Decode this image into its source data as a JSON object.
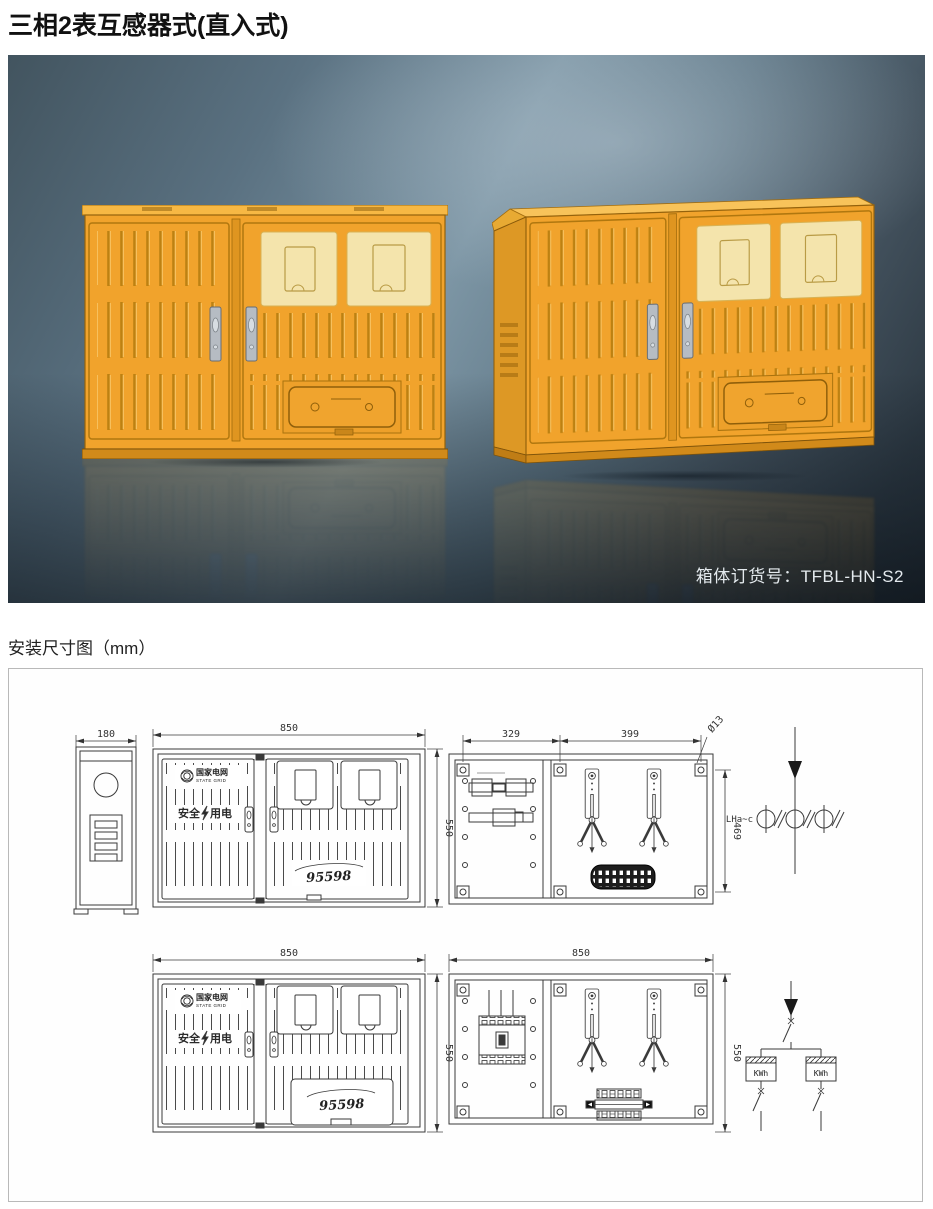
{
  "page": {
    "title": "三相2表互感器式(直入式)",
    "drawings_title": "安装尺寸图（mm）"
  },
  "photo": {
    "order_label": "箱体订货号：TFBL-HN-S2"
  },
  "branding": {
    "grid_cn": "国家电网",
    "grid_en": "STATE GRID",
    "safety_left": "安全",
    "safety_right": "用电",
    "hotline": "95598"
  },
  "dims": {
    "depth": "180",
    "width": "850",
    "height": "550",
    "mount_w1": "329",
    "mount_w2": "399",
    "mount_h": "469",
    "hole": "Ø13"
  },
  "schematics": {
    "ct_label": "LHa~c",
    "meter1": "KWh",
    "meter2": "KWh"
  }
}
